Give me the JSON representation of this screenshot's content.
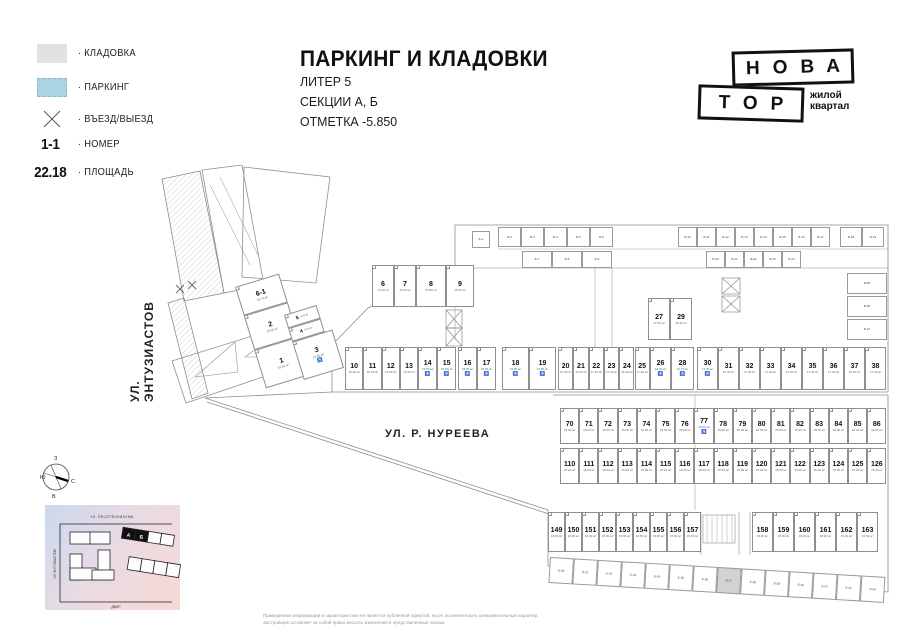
{
  "colors": {
    "storage_swatch": "#e2e2e2",
    "parking_swatch": "#a9d4e5",
    "highlight_cell": "#d2d2d2",
    "wall_line": "#8f8f8f"
  },
  "legend": {
    "storage_label": "· КЛАДОВКА",
    "parking_label": "· ПАРКИНГ",
    "entry_label": "· ВЪЕЗД/ВЫЕЗД",
    "number_example": "1-1",
    "number_label": "· НОМЕР",
    "area_example": "22.18",
    "area_label": "· ПЛОЩАДЬ"
  },
  "title": {
    "main": "ПАРКИНГ И КЛАДОВКИ",
    "sub": [
      "ЛИТЕР 5",
      "СЕКЦИИ А, Б",
      "ОТМЕТКА -5.850"
    ]
  },
  "logo": {
    "line1": "НОВА",
    "line2": "ТОР",
    "tagline1": "жилой",
    "tagline2": "квартал"
  },
  "streets": {
    "entuziastov": "УЛ. ЭНТУЗИАСТОВ",
    "nureeva": "УЛ. Р. НУРЕЕВА"
  },
  "compass": {
    "top": "З",
    "left": "Ю",
    "right": "С",
    "bottom": "В"
  },
  "minimap": {
    "street_top": "УЛ. ЛЕСОТЕХНИКУМА",
    "street_left": "УЛ. ЭНТУЗИАСТОВ",
    "street_bottom": "ДВОР",
    "section_a": "А",
    "section_b": "Б"
  },
  "disclaimer": [
    "Приведенная информация и характеристики не является публичной офертой, носят исключительно ознакомительный характер.",
    "Застройщик оставляет за собой право вносить изменения в представленные эскизы."
  ],
  "plan": {
    "stall_rows": [
      {
        "y": 100,
        "x": 222,
        "h": 42,
        "stalls": [
          {
            "n": "6",
            "a": "14.40 м²",
            "w": 22
          },
          {
            "n": "7",
            "a": "15.00 м²",
            "w": 22
          },
          {
            "n": "8",
            "a": "23.80 м²",
            "w": 30
          },
          {
            "n": "9",
            "a": "15.00 м²",
            "w": 28
          }
        ]
      },
      {
        "y": 133,
        "x": 498,
        "h": 42,
        "stalls": [
          {
            "n": "27",
            "a": "17.00 м²",
            "w": 22
          },
          {
            "n": "29",
            "a": "15.20 м²",
            "w": 22
          }
        ]
      },
      {
        "y": 182,
        "x": 195,
        "h": 43,
        "stalls": [
          {
            "n": "10",
            "a": "16.20 м²",
            "w": 18.3
          },
          {
            "n": "11",
            "a": "16.20 м²",
            "w": 18.3
          },
          {
            "n": "12",
            "a": "16.20 м²",
            "w": 18.3
          },
          {
            "n": "13",
            "a": "16.20 м²",
            "w": 18.3
          },
          {
            "n": "14",
            "a": "15.50 м²",
            "w": 19,
            "acc": true
          },
          {
            "n": "15",
            "a": "15.50 м²",
            "w": 19,
            "acc": true
          }
        ]
      },
      {
        "y": 182,
        "x": 308,
        "h": 43,
        "stalls": [
          {
            "n": "16",
            "a": "18.00 м²",
            "w": 19,
            "acc": true
          },
          {
            "n": "17",
            "a": "18.00 м²",
            "w": 19,
            "acc": true
          }
        ]
      },
      {
        "y": 182,
        "x": 352,
        "h": 43,
        "stalls": [
          {
            "n": "18",
            "a": "23.80 м²",
            "w": 27,
            "acc": true
          },
          {
            "n": "19",
            "a": "21.80 м²",
            "w": 27,
            "acc": true
          }
        ]
      },
      {
        "y": 182,
        "x": 408,
        "h": 43,
        "stalls": [
          {
            "n": "20",
            "a": "17.40 м²",
            "w": 15.3
          },
          {
            "n": "21",
            "a": "15.30 м²",
            "w": 15.3
          },
          {
            "n": "22",
            "a": "17.40 м²",
            "w": 15.3
          },
          {
            "n": "23",
            "a": "17.40 м²",
            "w": 15.3
          },
          {
            "n": "24",
            "a": "15.30 м²",
            "w": 15.3
          },
          {
            "n": "25",
            "a": "17.40 м²",
            "w": 15.3
          }
        ]
      },
      {
        "y": 182,
        "x": 500,
        "h": 43,
        "stalls": [
          {
            "n": "26",
            "a": "18.00 м²",
            "w": 21,
            "acc": true
          },
          {
            "n": "28",
            "a": "21.70 м²",
            "w": 23,
            "acc": true
          }
        ]
      },
      {
        "y": 182,
        "x": 547,
        "h": 43,
        "stalls": [
          {
            "n": "30",
            "a": "17.40 м²",
            "w": 21,
            "acc": true
          },
          {
            "n": "31",
            "a": "15.30 м²",
            "w": 21
          },
          {
            "n": "32",
            "a": "17.40 м²",
            "w": 21
          },
          {
            "n": "33",
            "a": "17.40 м²",
            "w": 21
          },
          {
            "n": "34",
            "a": "15.30 м²",
            "w": 21
          },
          {
            "n": "35",
            "a": "17.40 м²",
            "w": 21
          },
          {
            "n": "36",
            "a": "17.40 м²",
            "w": 21
          },
          {
            "n": "37",
            "a": "15.30 м²",
            "w": 21
          },
          {
            "n": "38",
            "a": "17.40 м²",
            "w": 21
          }
        ]
      },
      {
        "y": 243,
        "x": 410,
        "h": 36,
        "stalls": [
          {
            "n": "70",
            "a": "15.00 м²",
            "w": 19.2
          },
          {
            "n": "71",
            "a": "15.00 м²",
            "w": 19.2
          },
          {
            "n": "72",
            "a": "15.00 м²",
            "w": 19.2
          },
          {
            "n": "73",
            "a": "15.00 м²",
            "w": 19.2
          },
          {
            "n": "74",
            "a": "15.00 м²",
            "w": 19.2
          },
          {
            "n": "75",
            "a": "15.00 м²",
            "w": 19.2
          },
          {
            "n": "76",
            "a": "15.00 м²",
            "w": 19.2
          },
          {
            "n": "77",
            "a": "15.00 м²",
            "w": 19.2,
            "acc": true
          },
          {
            "n": "78",
            "a": "15.00 м²",
            "w": 19.2
          },
          {
            "n": "79",
            "a": "15.00 м²",
            "w": 19.2
          },
          {
            "n": "80",
            "a": "15.00 м²",
            "w": 19.2
          },
          {
            "n": "81",
            "a": "15.00 м²",
            "w": 19.2
          },
          {
            "n": "82",
            "a": "15.00 м²",
            "w": 19.2
          },
          {
            "n": "83",
            "a": "15.00 м²",
            "w": 19.2
          },
          {
            "n": "84",
            "a": "15.00 м²",
            "w": 19.2
          },
          {
            "n": "85",
            "a": "15.00 м²",
            "w": 19.2
          },
          {
            "n": "86",
            "a": "15.00 м²",
            "w": 19.2
          }
        ]
      },
      {
        "y": 283,
        "x": 410,
        "h": 36,
        "stalls": [
          {
            "n": "110",
            "a": "15.00 м²",
            "w": 19.2
          },
          {
            "n": "111",
            "a": "15.00 м²",
            "w": 19.2
          },
          {
            "n": "112",
            "a": "15.00 м²",
            "w": 19.2
          },
          {
            "n": "113",
            "a": "15.00 м²",
            "w": 19.2
          },
          {
            "n": "114",
            "a": "15.00 м²",
            "w": 19.2
          },
          {
            "n": "115",
            "a": "15.00 м²",
            "w": 19.2
          },
          {
            "n": "116",
            "a": "15.00 м²",
            "w": 19.2
          },
          {
            "n": "117",
            "a": "15.00 м²",
            "w": 19.2
          },
          {
            "n": "118",
            "a": "15.00 м²",
            "w": 19.2
          },
          {
            "n": "119",
            "a": "15.00 м²",
            "w": 19.2
          },
          {
            "n": "120",
            "a": "15.00 м²",
            "w": 19.2
          },
          {
            "n": "121",
            "a": "15.00 м²",
            "w": 19.2
          },
          {
            "n": "122",
            "a": "15.00 м²",
            "w": 19.2
          },
          {
            "n": "123",
            "a": "15.00 м²",
            "w": 19.2
          },
          {
            "n": "124",
            "a": "15.00 м²",
            "w": 19.2
          },
          {
            "n": "125",
            "a": "15.00 м²",
            "w": 19.2
          },
          {
            "n": "126",
            "a": "15.00 м²",
            "w": 19.2
          }
        ]
      },
      {
        "y": 347,
        "x": 398,
        "h": 40,
        "stalls": [
          {
            "n": "149",
            "a": "18.00 м²",
            "w": 17
          },
          {
            "n": "150",
            "a": "18.00 м²",
            "w": 17
          },
          {
            "n": "151",
            "a": "18.00 м²",
            "w": 17
          },
          {
            "n": "152",
            "a": "15.00 м²",
            "w": 17
          },
          {
            "n": "153",
            "a": "15.00 м²",
            "w": 17
          },
          {
            "n": "154",
            "a": "16.50 м²",
            "w": 17
          },
          {
            "n": "155",
            "a": "15.00 м²",
            "w": 17
          },
          {
            "n": "156",
            "a": "15.00 м²",
            "w": 17
          },
          {
            "n": "157",
            "a": "15.00 м²",
            "w": 17
          }
        ]
      },
      {
        "y": 347,
        "x": 602,
        "h": 40,
        "stalls": [
          {
            "n": "158",
            "a": "15.00 м²",
            "w": 21
          },
          {
            "n": "159",
            "a": "15.00 м²",
            "w": 21
          },
          {
            "n": "160",
            "a": "18.00 м²",
            "w": 21
          },
          {
            "n": "161",
            "a": "18.00 м²",
            "w": 21
          },
          {
            "n": "162",
            "a": "15.00 м²",
            "w": 21
          },
          {
            "n": "163",
            "a": "15.50 м²",
            "w": 21
          }
        ]
      }
    ],
    "rot_groups": [
      {
        "x": 85,
        "y": 122,
        "angle": -17,
        "stalls": [
          {
            "n": "6-1",
            "a": "22.76 м²",
            "w": 46,
            "h": 30
          },
          {
            "n": "2",
            "a": "29.50 м²",
            "w": 46,
            "h": 36
          },
          {
            "n": "1",
            "a": "29.50 м²",
            "w": 46,
            "h": 40
          }
        ]
      },
      {
        "x": 134,
        "y": 150,
        "angle": -17,
        "stalls": [
          {
            "n": "5",
            "a": "8.00 м²",
            "w": 34,
            "h": 14,
            "small": true
          },
          {
            "n": "4",
            "a": "8.00 м²",
            "w": 34,
            "h": 14,
            "small": true
          },
          {
            "n": "3",
            "a": "24.80 м²",
            "w": 42,
            "h": 40,
            "acc": true
          }
        ]
      }
    ],
    "storage_rows": [
      {
        "x": 322,
        "y": 66,
        "h": 17,
        "cells": [
          {
            "l": "Б-1",
            "w": 18
          }
        ]
      },
      {
        "x": 348,
        "y": 62,
        "h": 20,
        "cells": [
          {
            "l": "Б-2",
            "w": 23
          },
          {
            "l": "Б-3",
            "w": 23
          },
          {
            "l": "Б-4",
            "w": 23
          },
          {
            "l": "Б-5",
            "w": 23
          },
          {
            "l": "Б-6",
            "w": 23
          }
        ]
      },
      {
        "x": 372,
        "y": 86,
        "h": 17,
        "cells": [
          {
            "l": "Б-7",
            "w": 30
          },
          {
            "l": "Б-8",
            "w": 30
          },
          {
            "l": "Б-9",
            "w": 30
          }
        ]
      },
      {
        "x": 528,
        "y": 62,
        "h": 20,
        "cells": [
          {
            "l": "Б-10",
            "w": 19
          },
          {
            "l": "Б-11",
            "w": 19
          },
          {
            "l": "Б-12",
            "w": 19
          },
          {
            "l": "Б-13",
            "w": 19
          },
          {
            "l": "Б-14",
            "w": 19
          },
          {
            "l": "Б-15",
            "w": 19
          },
          {
            "l": "Б-16",
            "w": 19
          },
          {
            "l": "Б-17",
            "w": 19
          }
        ]
      },
      {
        "x": 690,
        "y": 62,
        "h": 20,
        "cells": [
          {
            "l": "Б-18",
            "w": 22
          },
          {
            "l": "Б-19",
            "w": 22
          }
        ]
      },
      {
        "x": 556,
        "y": 86,
        "h": 17,
        "cells": [
          {
            "l": "Б-20",
            "w": 19
          },
          {
            "l": "Б-21",
            "w": 19
          },
          {
            "l": "Б-22",
            "w": 19
          },
          {
            "l": "Б-23",
            "w": 19
          },
          {
            "l": "Б-24",
            "w": 19
          }
        ]
      },
      {
        "x": 697,
        "y": 108,
        "h": 21,
        "cells": [
          {
            "l": "Б-25",
            "w": 40
          }
        ]
      },
      {
        "x": 697,
        "y": 131,
        "h": 21,
        "cells": [
          {
            "l": "Б-26",
            "w": 40
          }
        ]
      },
      {
        "x": 697,
        "y": 154,
        "h": 21,
        "cells": [
          {
            "l": "Б-27",
            "w": 40
          }
        ]
      },
      {
        "x": 400,
        "y": 392,
        "h": 26,
        "angle": 3.4,
        "cells": [
          {
            "l": "Б-30",
            "w": 24
          },
          {
            "l": "Б-31",
            "w": 24
          },
          {
            "l": "Б-32",
            "w": 24
          },
          {
            "l": "Б-33",
            "w": 24
          },
          {
            "l": "Б-34",
            "w": 24
          },
          {
            "l": "Б-35",
            "w": 24
          },
          {
            "l": "Б-36",
            "w": 24
          },
          {
            "l": "Б-37",
            "w": 24,
            "hl": true
          },
          {
            "l": "Б-38",
            "w": 24
          },
          {
            "l": "Б-39",
            "w": 24
          },
          {
            "l": "Б-40",
            "w": 24
          },
          {
            "l": "Б-41",
            "w": 24
          },
          {
            "l": "Б-42",
            "w": 24
          },
          {
            "l": "Б-43",
            "w": 24
          }
        ]
      }
    ]
  }
}
